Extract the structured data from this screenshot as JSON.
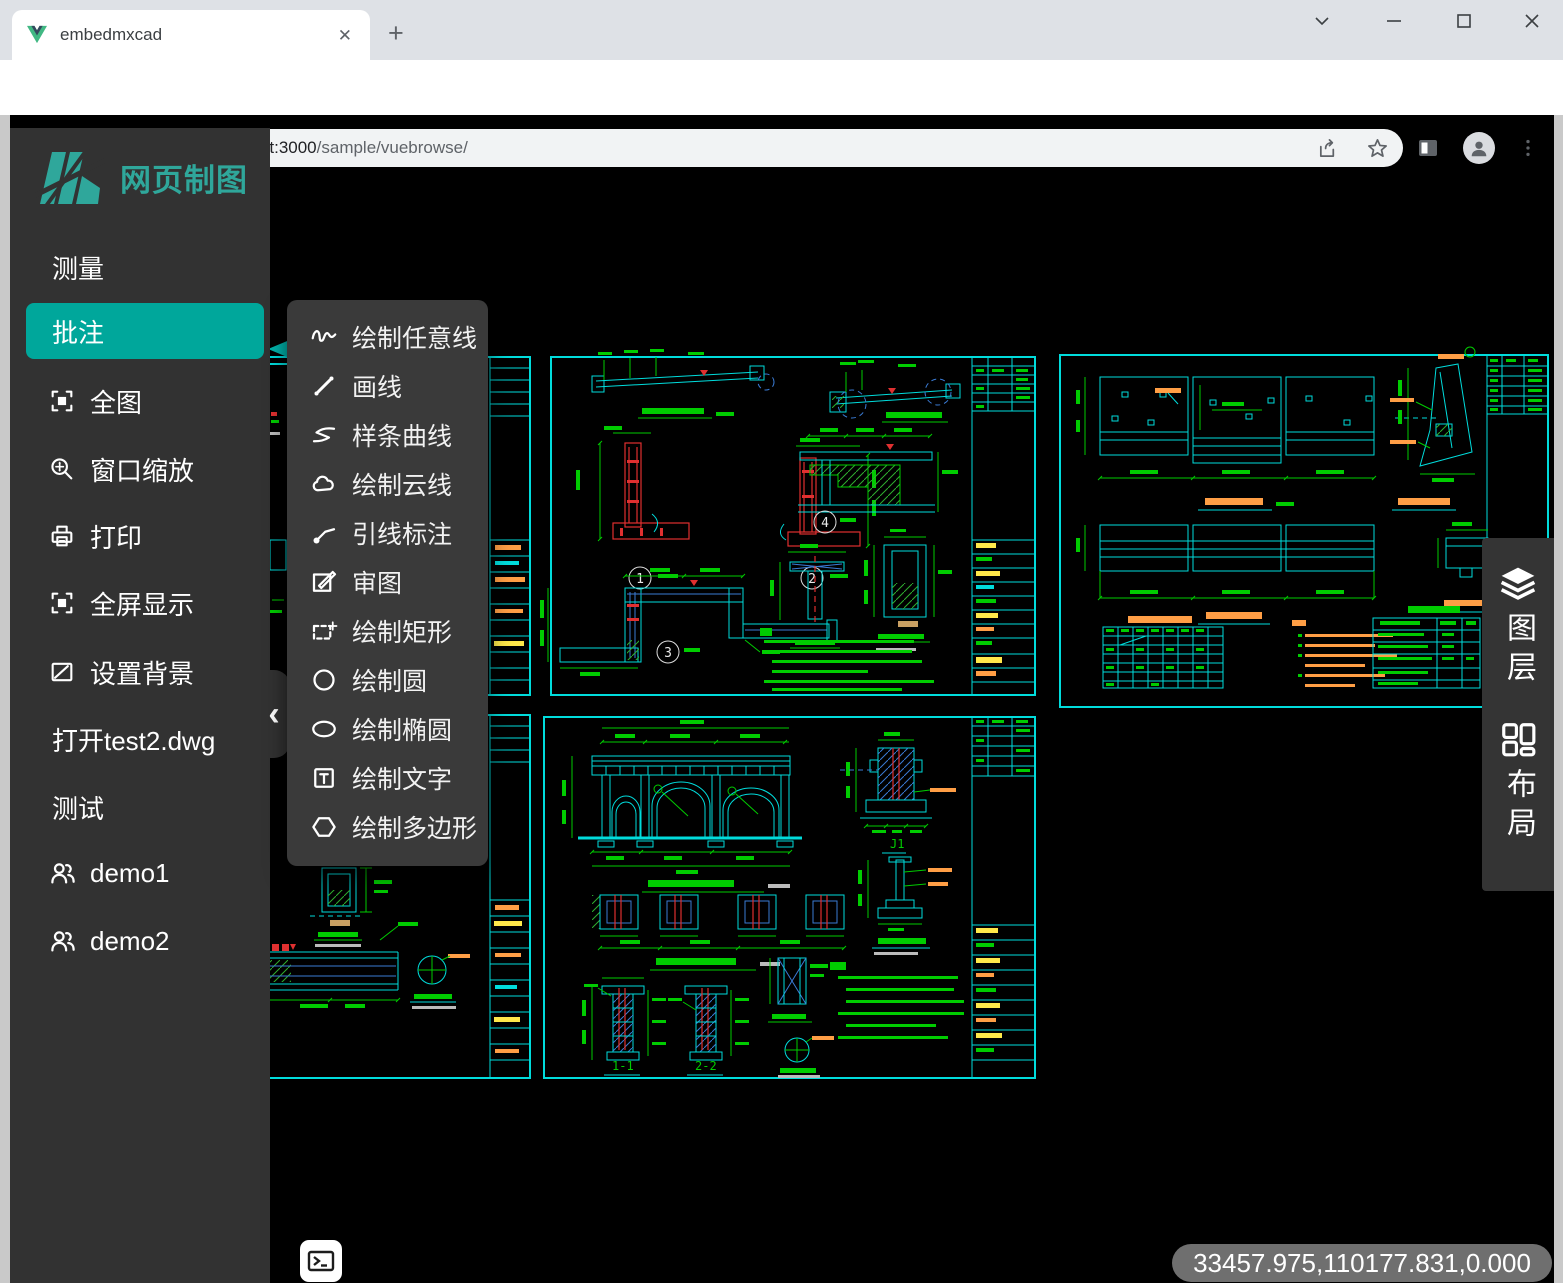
{
  "browser": {
    "tab_title": "embedmxcad",
    "tab_close_glyph": "✕",
    "new_tab_glyph": "+",
    "url_host": "localhost:3000",
    "url_path": "/sample/vuebrowse/"
  },
  "sidebar": {
    "logo_text": "网页制图",
    "collapse_glyph": "‹",
    "items": [
      {
        "label": "测量",
        "icon": null,
        "active": false
      },
      {
        "label": "批注",
        "icon": null,
        "active": true
      },
      {
        "label": "全图",
        "icon": "fullscreen-frame-icon",
        "active": false
      },
      {
        "label": "窗口缩放",
        "icon": "zoom-window-icon",
        "active": false
      },
      {
        "label": "打印",
        "icon": "printer-icon",
        "active": false
      },
      {
        "label": "全屏显示",
        "icon": "fullscreen-frame-icon",
        "active": false
      },
      {
        "label": "设置背景",
        "icon": "background-image-icon",
        "active": false
      },
      {
        "label": "打开test2.dwg",
        "icon": null,
        "active": false
      },
      {
        "label": "测试",
        "icon": null,
        "active": false
      },
      {
        "label": "demo1",
        "icon": "users-icon",
        "active": false
      },
      {
        "label": "demo2",
        "icon": "users-icon",
        "active": false
      }
    ]
  },
  "tools_menu": {
    "items": [
      {
        "label": "绘制任意线",
        "icon": "freehand-line-icon"
      },
      {
        "label": "画线",
        "icon": "line-icon"
      },
      {
        "label": "样条曲线",
        "icon": "spline-icon"
      },
      {
        "label": "绘制云线",
        "icon": "cloud-line-icon"
      },
      {
        "label": "引线标注",
        "icon": "leader-annotation-icon"
      },
      {
        "label": "审图",
        "icon": "review-drawing-icon"
      },
      {
        "label": "绘制矩形",
        "icon": "rectangle-icon"
      },
      {
        "label": "绘制圆",
        "icon": "circle-icon"
      },
      {
        "label": "绘制椭圆",
        "icon": "ellipse-icon"
      },
      {
        "label": "绘制文字",
        "icon": "text-icon"
      },
      {
        "label": "绘制多边形",
        "icon": "polygon-icon"
      }
    ]
  },
  "right_panel": {
    "items": [
      {
        "label": "图层",
        "icon": "layers-icon"
      },
      {
        "label": "布局",
        "icon": "layout-icon"
      }
    ]
  },
  "statusbar": {
    "coordinates": "33457.975,110177.831,0.000"
  },
  "canvas": {
    "sheet_mid_top": {
      "callouts": [
        "1",
        "2",
        "3",
        "4"
      ]
    },
    "sheet_mid_bottom": {
      "section_labels": [
        "1-1",
        "2-2",
        "J1"
      ]
    }
  },
  "colors": {
    "accent_teal": "#00a79b",
    "logo_teal": "#2fa79b",
    "cad_cyan": "#00dcdc",
    "cad_green": "#00cc00",
    "cad_red": "#e03030",
    "cad_blue": "#3a7bd5",
    "cad_orange": "#ff9e45",
    "cad_yellow": "#ffe84a"
  }
}
